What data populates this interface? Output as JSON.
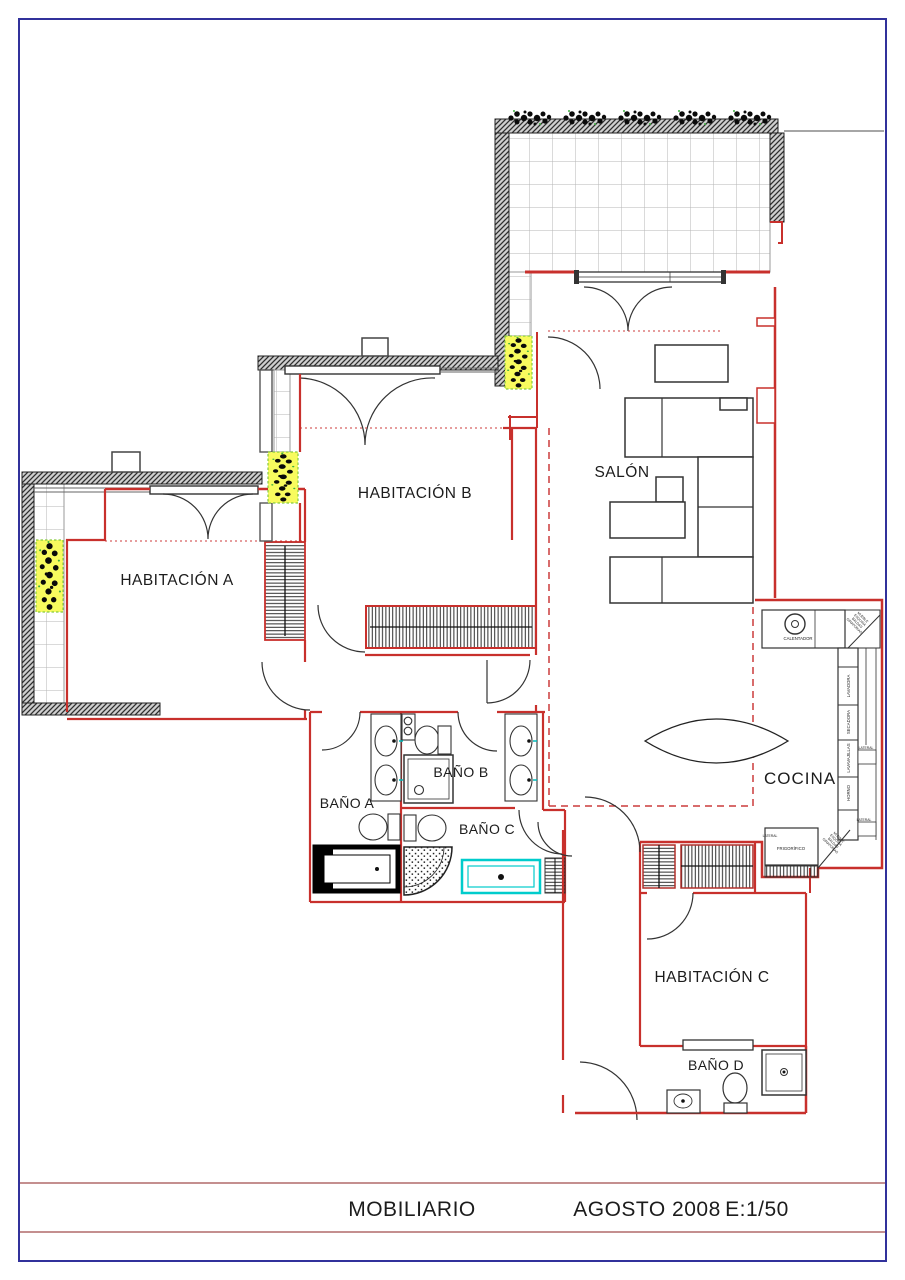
{
  "sheet": {
    "title_block": {
      "drawing_title": "MOBILIARIO",
      "date": "AGOSTO 2008",
      "scale": "E:1/50"
    }
  },
  "rooms": {
    "habitacion_a": "HABITACIÓN A",
    "habitacion_b": "HABITACIÓN B",
    "habitacion_c": "HABITACIÓN C",
    "salon": "SALÓN",
    "cocina": "COCINA",
    "bano_a": "BAÑO A",
    "bano_b": "BAÑO B",
    "bano_c": "BAÑO C",
    "bano_d": "BAÑO D"
  },
  "kitchen": {
    "calentador": "CALENTADOR",
    "lavadora": "LAVADORA",
    "secadora": "SECADORA",
    "lavavajillas": "LAVAVAJILLAS",
    "horno": "HORNO",
    "frigorifico": "FRIGORÍFICO",
    "lateral": "LATERAL",
    "corner_cabinet_lines": [
      "MUEBLE",
      "ESQUINA",
      "BALDAS",
      "GIRATORIAS"
    ]
  },
  "colors": {
    "frame": "#31319b",
    "wall_red": "#c8302c",
    "wall_dark": "#2e2e2e",
    "dashed_red": "#cc3b3b",
    "title_line": "#b06a6a",
    "plant_box_fill": "#f8fb5e",
    "plant_box_border": "#86c93e",
    "highlight_cyan": "#00cccc",
    "tile_line": "#b5b5b5"
  }
}
